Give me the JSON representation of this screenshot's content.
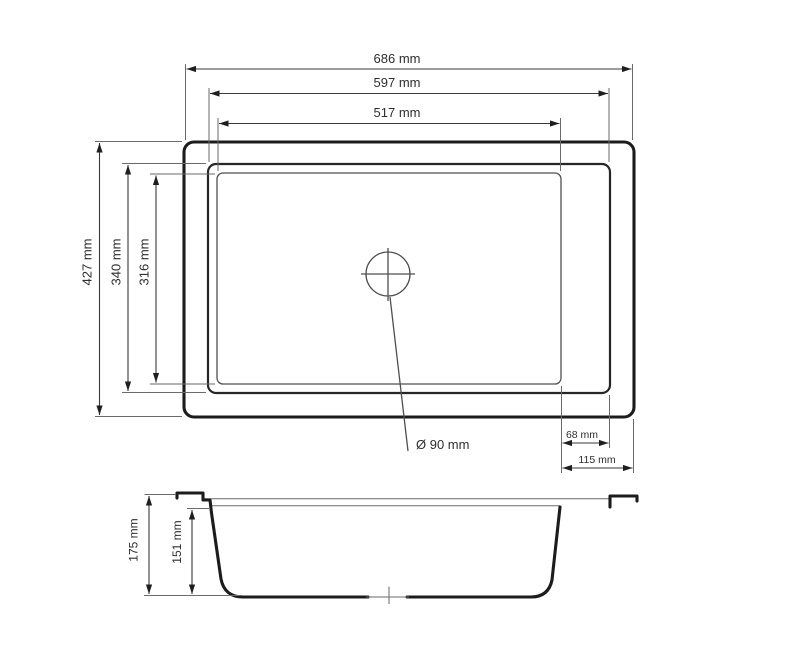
{
  "drawing": {
    "background_color": "#ffffff",
    "line_color": "#1c1c1c",
    "dimension_line_color": "#3a3a3a",
    "text_color": "#2e2e2e"
  },
  "top_view": {
    "outer_width": "686 mm",
    "rim_width": "597 mm",
    "basin_width": "517 mm",
    "outer_depth": "427 mm",
    "rim_depth": "340 mm",
    "basin_depth": "316 mm",
    "drain_diameter": "Ø 90 mm",
    "basin_to_rim_offset": "68 mm",
    "basin_to_edge_offset": "115 mm"
  },
  "side_view": {
    "total_height": "175 mm",
    "bowl_depth": "151 mm"
  }
}
